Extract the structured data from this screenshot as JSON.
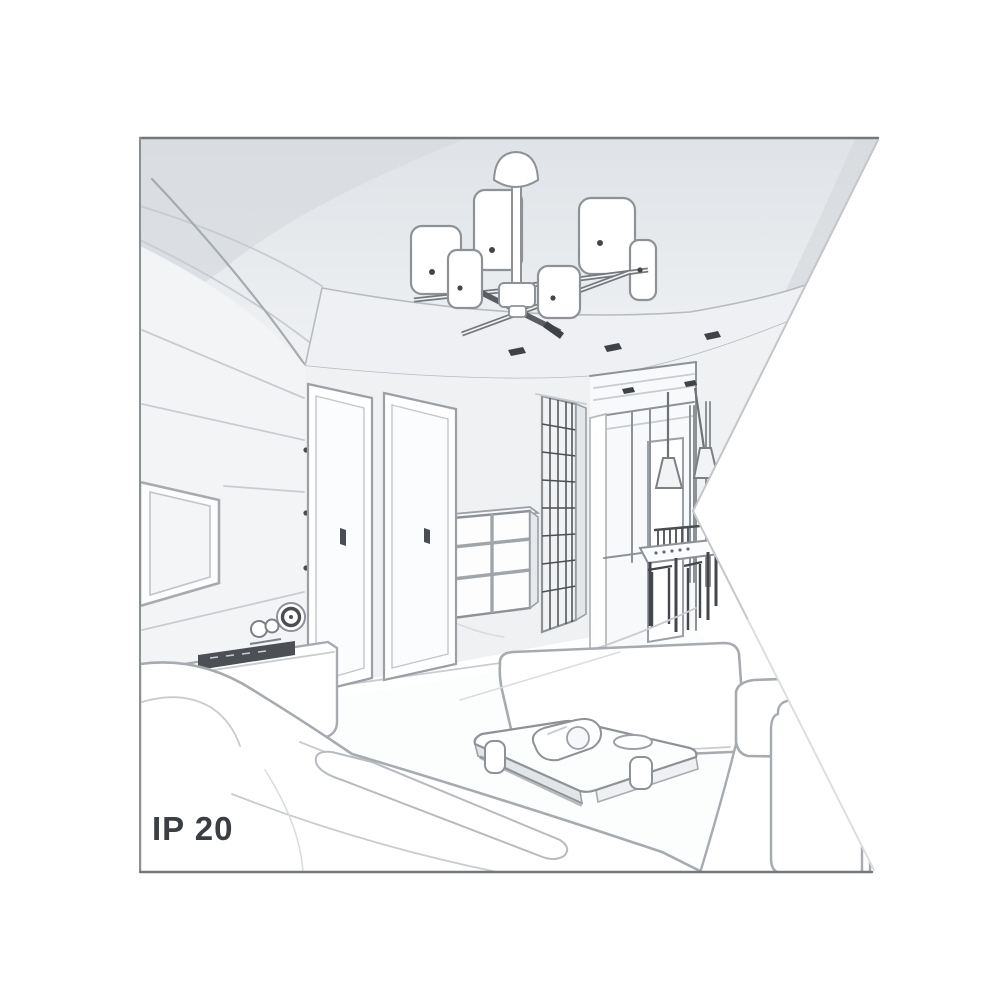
{
  "image": {
    "type": "interior-sketch-illustration",
    "style": "grayscale perspective line drawing of a living room",
    "shape_note": "square framed drawing with a white wedge notch cut into the right edge"
  },
  "labels": {
    "ip_rating": "IP 20"
  },
  "palette": {
    "background": "#ffffff",
    "frame_border": "#75787b",
    "line": "#a6abb0",
    "line_light": "#c8ccd0",
    "line_dark": "#4a4e52",
    "accent_dark": "#3f4347",
    "ceiling_shade": "#d8dce0",
    "soffit": "#eef0f3",
    "wall": "#eff1f3",
    "wall_left": "#f3f4f6",
    "floor": "#fcfdfd"
  },
  "objects": [
    "ceiling-chandelier",
    "ceiling-spotlights",
    "left-wall-planks",
    "tv-screen",
    "tv-bench",
    "soundbar",
    "wall-clock",
    "figurine",
    "door-left",
    "door-right",
    "chest-of-drawers",
    "grid-wardrobe",
    "hallway",
    "pendant-lamps",
    "dining-table",
    "dining-chairs",
    "sofa-left",
    "daybed-center",
    "coffee-table",
    "table-items",
    "armchair-right",
    "ip-rating-label"
  ]
}
